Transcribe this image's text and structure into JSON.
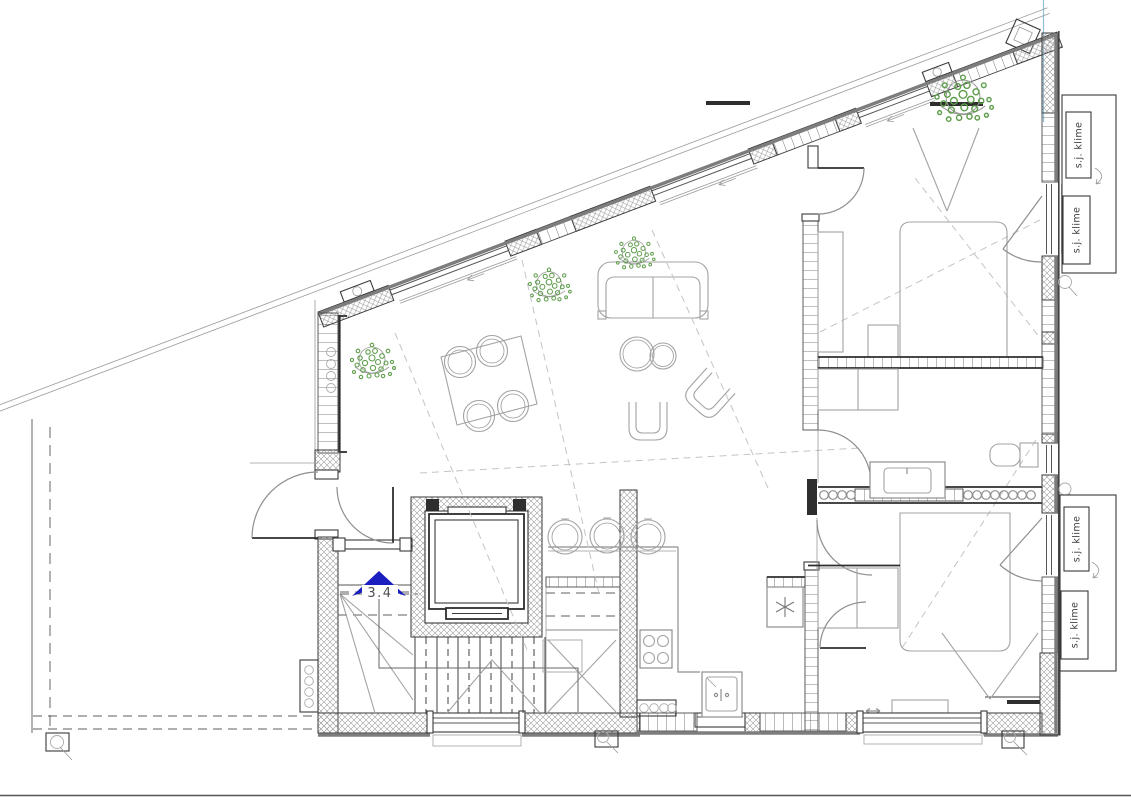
{
  "plan": {
    "labels": {
      "stair_arrow": "3.4"
    },
    "ac_units": [
      {
        "label": "s.j. klime"
      },
      {
        "label": "s.j. klime"
      },
      {
        "label": "s.j. klime"
      },
      {
        "label": "s.j. klime"
      }
    ],
    "colors": {
      "wall_outline": "#3a3a3a",
      "wall_thick_gray": "#7d7d7d",
      "hatch_line": "#9a9a9a",
      "furniture_line": "#a3a3a3",
      "dashed_guide": "#c4c4c4",
      "plant_green": "#5f9e4c",
      "arrow_blue": "#1b1fc0",
      "alignment_guide_blue": "#92bfd8",
      "label_text": "#3c3c3c"
    }
  }
}
